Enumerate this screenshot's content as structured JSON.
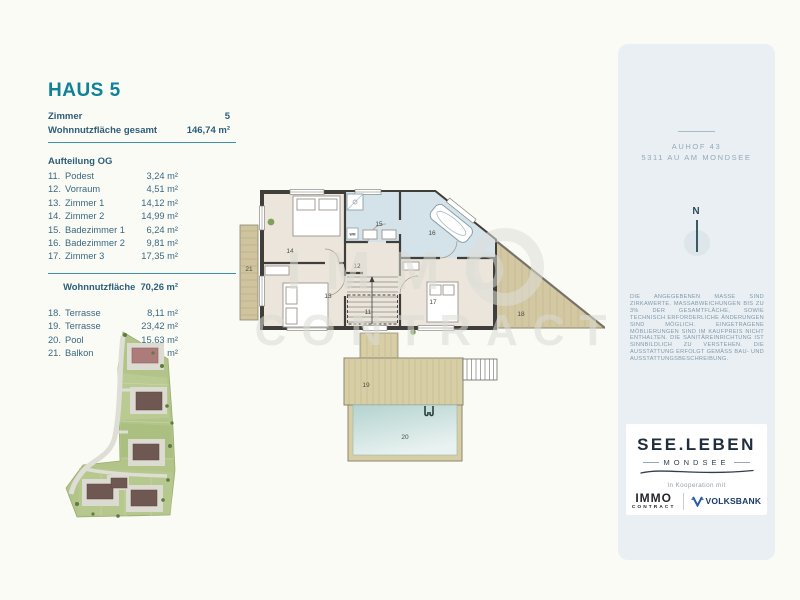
{
  "listing": {
    "title": "HAUS 5",
    "summary": [
      {
        "label": "Zimmer",
        "value": "5"
      },
      {
        "label": "Wohnnutzfläche gesamt",
        "value": "146,74 m²"
      }
    ],
    "section": "Aufteilung OG",
    "rooms": [
      {
        "nr": "11.",
        "name": "Podest",
        "area": "3,24 m²"
      },
      {
        "nr": "12.",
        "name": "Vorraum",
        "area": "4,51 m²"
      },
      {
        "nr": "13.",
        "name": "Zimmer 1",
        "area": "14,12 m²"
      },
      {
        "nr": "14.",
        "name": "Zimmer 2",
        "area": "14,99 m²"
      },
      {
        "nr": "15.",
        "name": "Badezimmer 1",
        "area": "6,24 m²"
      },
      {
        "nr": "16.",
        "name": "Badezimmer 2",
        "area": "9,81 m²"
      },
      {
        "nr": "17.",
        "name": "Zimmer 3",
        "area": "17,35 m²"
      }
    ],
    "subtotal": {
      "label": "Wohnnutzfläche",
      "value": "70,26 m²"
    },
    "outdoor": [
      {
        "nr": "18.",
        "name": "Terrasse",
        "area": "8,11 m²"
      },
      {
        "nr": "19.",
        "name": "Terrasse",
        "area": "23,42 m²"
      },
      {
        "nr": "20.",
        "name": "Pool",
        "area": "15,63 m²"
      },
      {
        "nr": "21.",
        "name": "Balkon",
        "area": "5,56 m²"
      }
    ]
  },
  "floor_plan": {
    "labels": {
      "r11": "11",
      "r12": "12",
      "r13": "13",
      "r14": "14",
      "r15": "15",
      "r16": "16",
      "r17": "17",
      "r18": "18",
      "r19": "19",
      "r20": "20",
      "r21": "21",
      "wm_appliance": "WM"
    }
  },
  "watermark": {
    "line1": "IMMO",
    "line2": "CONTRACT"
  },
  "side_panel": {
    "address_line1": "AUHOF 43",
    "address_line2": "5311 AU AM MONDSEE",
    "compass": "N",
    "disclaimer": "DIE ANGEGEBENEN MASSE SIND ZIRKAWERTE. MASSABWEICHUNGEN BIS ZU 3% DER GESAMTFLÄCHE, SOWIE TECHNISCH ERFORDERLICHE ÄNDERUNGEN SIND MÖGLICH. EINGETRAGENE MÖBLIERUNGEN SIND IM KAUFPREIS NICHT ENTHALTEN. DIE SANITÄREINRICHTUNG IST SINNBILDLICH ZU VERSTEHEN. DIE AUSSTATTUNG ERFOLGT GEMÄSS BAU- UND AUSSTATTUNGSBESCHREIBUNG.",
    "brand": {
      "name": "SEE.LEBEN",
      "place": "MONDSEE",
      "coop": "In Kooperation mit",
      "immo_line1": "IMMO",
      "immo_line2": "CONTRACT",
      "volksbank": "VOLKSBANK"
    }
  },
  "colors": {
    "accent_teal": "#0d8298",
    "body_text": "#35607a",
    "panel_bg": "#e9eff3",
    "bath_fill": "#d4e3ea",
    "room_fill": "#ece5dc",
    "deck_fill": "#d8cea6",
    "pool_fill": "#bcd8d4",
    "site_green": "#b3c489",
    "wall": "#3f3e3b"
  }
}
